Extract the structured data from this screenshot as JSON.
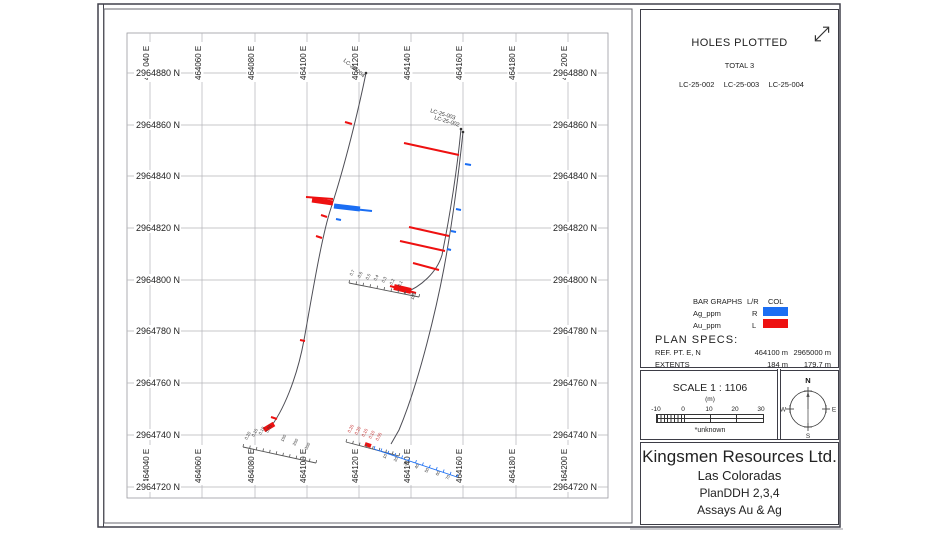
{
  "holes_plotted": {
    "title": "HOLES PLOTTED",
    "total": "TOTAL 3",
    "holes": [
      "LC-25-002",
      "LC-25-003",
      "LC-25-004"
    ]
  },
  "legend": {
    "header": {
      "col1": "BAR GRAPHS",
      "col2": "L/R",
      "col3": "COL"
    },
    "rows": [
      {
        "name": "Ag_ppm",
        "lr": "R",
        "color": "#1b6ef3"
      },
      {
        "name": "Au_ppm",
        "lr": "L",
        "color": "#ee1111"
      }
    ]
  },
  "plan_specs": {
    "title": "PLAN  SPECS:",
    "rows": [
      {
        "label": "REF. PT.  E, N",
        "v1": "464100 m",
        "v2": "2965000 m"
      },
      {
        "label": "EXTENTS",
        "v1": "184 m",
        "v2": "179.7 m"
      }
    ]
  },
  "scale_box": {
    "title": "SCALE  1 : 1106",
    "unit": "(m)",
    "ticks": [
      "-10",
      "0",
      "10",
      "20",
      "30"
    ],
    "note": "*unknown"
  },
  "compass": {
    "n": "N",
    "e": "E",
    "s": "S",
    "w": "W"
  },
  "title_block": {
    "company": "Kingsmen Resources Ltd.",
    "project": "Las Coloradas",
    "drawing": "PlanDDH 2,3,4",
    "subtitle": "Assays Au & Ag"
  },
  "map": {
    "frame": {
      "left": 127,
      "top": 33,
      "right": 608,
      "bottom": 498
    },
    "eastings": [
      {
        "label": "464040 E",
        "x": 150
      },
      {
        "label": "464060 E",
        "x": 202
      },
      {
        "label": "464080 E",
        "x": 255
      },
      {
        "label": "464100 E",
        "x": 307
      },
      {
        "label": "464120 E",
        "x": 359
      },
      {
        "label": "464140 E",
        "x": 411
      },
      {
        "label": "464160 E",
        "x": 463
      },
      {
        "label": "464180 E",
        "x": 516
      },
      {
        "label": "464200 E",
        "x": 568
      }
    ],
    "northings": [
      {
        "label": "2964880 N",
        "y": 73
      },
      {
        "label": "2964860 N",
        "y": 125
      },
      {
        "label": "2964840 N",
        "y": 176
      },
      {
        "label": "2964820 N",
        "y": 228
      },
      {
        "label": "2964800 N",
        "y": 280
      },
      {
        "label": "2964780 N",
        "y": 331
      },
      {
        "label": "2964760 N",
        "y": 383
      },
      {
        "label": "2964740 N",
        "y": 435
      },
      {
        "label": "2964720 N",
        "y": 487
      }
    ],
    "holes": [
      {
        "name": "LC-25-004",
        "label": {
          "x": 343,
          "y": 61,
          "rot": 40
        },
        "collar": [
          366,
          73
        ],
        "path": "M366,73 C358,112 345,165 331,208 C322,235 313,290 304,340 C297,378 283,412 269,429"
      },
      {
        "name": "LC-25-003",
        "label": {
          "x": 430,
          "y": 112,
          "rot": 17
        },
        "collar": [
          463,
          132
        ],
        "path": "M463,132 C458,180 452,225 444,268 C437,305 420,380 399,430 L391,444"
      },
      {
        "name": "LC-25-002",
        "label": {
          "x": 434,
          "y": 119,
          "rot": 17
        },
        "collar": [
          461,
          129
        ],
        "path": "M461,129 C457,170 450,215 442,255 C437,272 421,287 404,293"
      }
    ],
    "bars": [
      [
        352,
        124,
        345,
        122,
        "#ee1111",
        2
      ],
      [
        333,
        199,
        306,
        197,
        "#ee1111",
        2
      ],
      [
        333,
        203,
        312,
        200,
        "#ee1111",
        5
      ],
      [
        334,
        207,
        372,
        211,
        "#1b6ef3",
        2
      ],
      [
        334,
        206,
        360,
        209,
        "#1b6ef3",
        5
      ],
      [
        327,
        217,
        321,
        215,
        "#ee1111",
        2
      ],
      [
        336,
        219,
        341,
        220,
        "#1b6ef3",
        2
      ],
      [
        322,
        238,
        316,
        236,
        "#ee1111",
        2
      ],
      [
        305,
        341,
        300,
        340,
        "#ee1111",
        2
      ],
      [
        459,
        155,
        404,
        143,
        "#ee1111",
        2
      ],
      [
        465,
        164,
        471,
        165,
        "#1b6ef3",
        2
      ],
      [
        449,
        236,
        409,
        227,
        "#ee1111",
        2
      ],
      [
        445,
        251,
        400,
        241,
        "#ee1111",
        2
      ],
      [
        439,
        270,
        413,
        263,
        "#ee1111",
        2
      ],
      [
        456,
        209,
        461,
        210,
        "#1b6ef3",
        2
      ],
      [
        451,
        231,
        456,
        232,
        "#1b6ef3",
        2
      ],
      [
        447,
        249,
        451,
        250,
        "#1b6ef3",
        2
      ],
      [
        411,
        291,
        394,
        287,
        "#ee1111",
        6
      ],
      [
        416,
        293,
        390,
        286,
        "#ee1111",
        2
      ],
      [
        274,
        424,
        264,
        430,
        "#ee1111",
        5
      ],
      [
        277,
        419,
        271,
        417,
        "#ee1111",
        2
      ],
      [
        371,
        446,
        365,
        444,
        "#ee1111",
        4
      ]
    ],
    "rulers": [
      {
        "x1": 243,
        "y1": 447,
        "x2": 316,
        "y2": 463,
        "n": 11,
        "color": "#555",
        "labels": [
          [
            "0.20",
            247,
            440
          ],
          [
            "0.15",
            254,
            437
          ],
          [
            "0.10",
            261,
            435
          ],
          [
            "0.05",
            268,
            433
          ],
          [
            "150",
            283,
            442
          ],
          [
            "250",
            295,
            446
          ],
          [
            "350",
            307,
            450
          ]
        ]
      },
      {
        "x1": 349,
        "y1": 283,
        "x2": 419,
        "y2": 297,
        "n": 10,
        "color": "#555",
        "labels": [
          [
            "0.7",
            352,
            276
          ],
          [
            "0.6",
            360,
            278
          ],
          [
            "0.5",
            368,
            280
          ],
          [
            "0.4",
            376,
            281
          ],
          [
            "0.3",
            384,
            283
          ],
          [
            "0.2",
            392,
            285
          ],
          [
            "0.1",
            400,
            287
          ],
          [
            "100",
            413,
            300
          ]
        ]
      },
      {
        "x1": 346,
        "y1": 442,
        "x2": 399,
        "y2": 456,
        "n": 8,
        "color": "#555",
        "labels": [
          [
            "0.25",
            350,
            433,
            "#c22222"
          ],
          [
            "0.20",
            357,
            435,
            "#c22222"
          ],
          [
            "0.15",
            364,
            437,
            "#c22222"
          ],
          [
            "0.10",
            371,
            439,
            "#c22222"
          ],
          [
            "0.05",
            378,
            441,
            "#c22222"
          ]
        ]
      },
      {
        "x1": 374,
        "y1": 449,
        "x2": 457,
        "y2": 477,
        "n": 12,
        "color": "#1b6ef3",
        "labels": [
          [
            "10",
            385,
            459
          ],
          [
            "20",
            396,
            462
          ],
          [
            "30",
            406,
            466
          ],
          [
            "40",
            417,
            469
          ],
          [
            "50",
            427,
            473
          ],
          [
            "60",
            438,
            476
          ],
          [
            "70",
            448,
            480
          ]
        ]
      }
    ]
  }
}
